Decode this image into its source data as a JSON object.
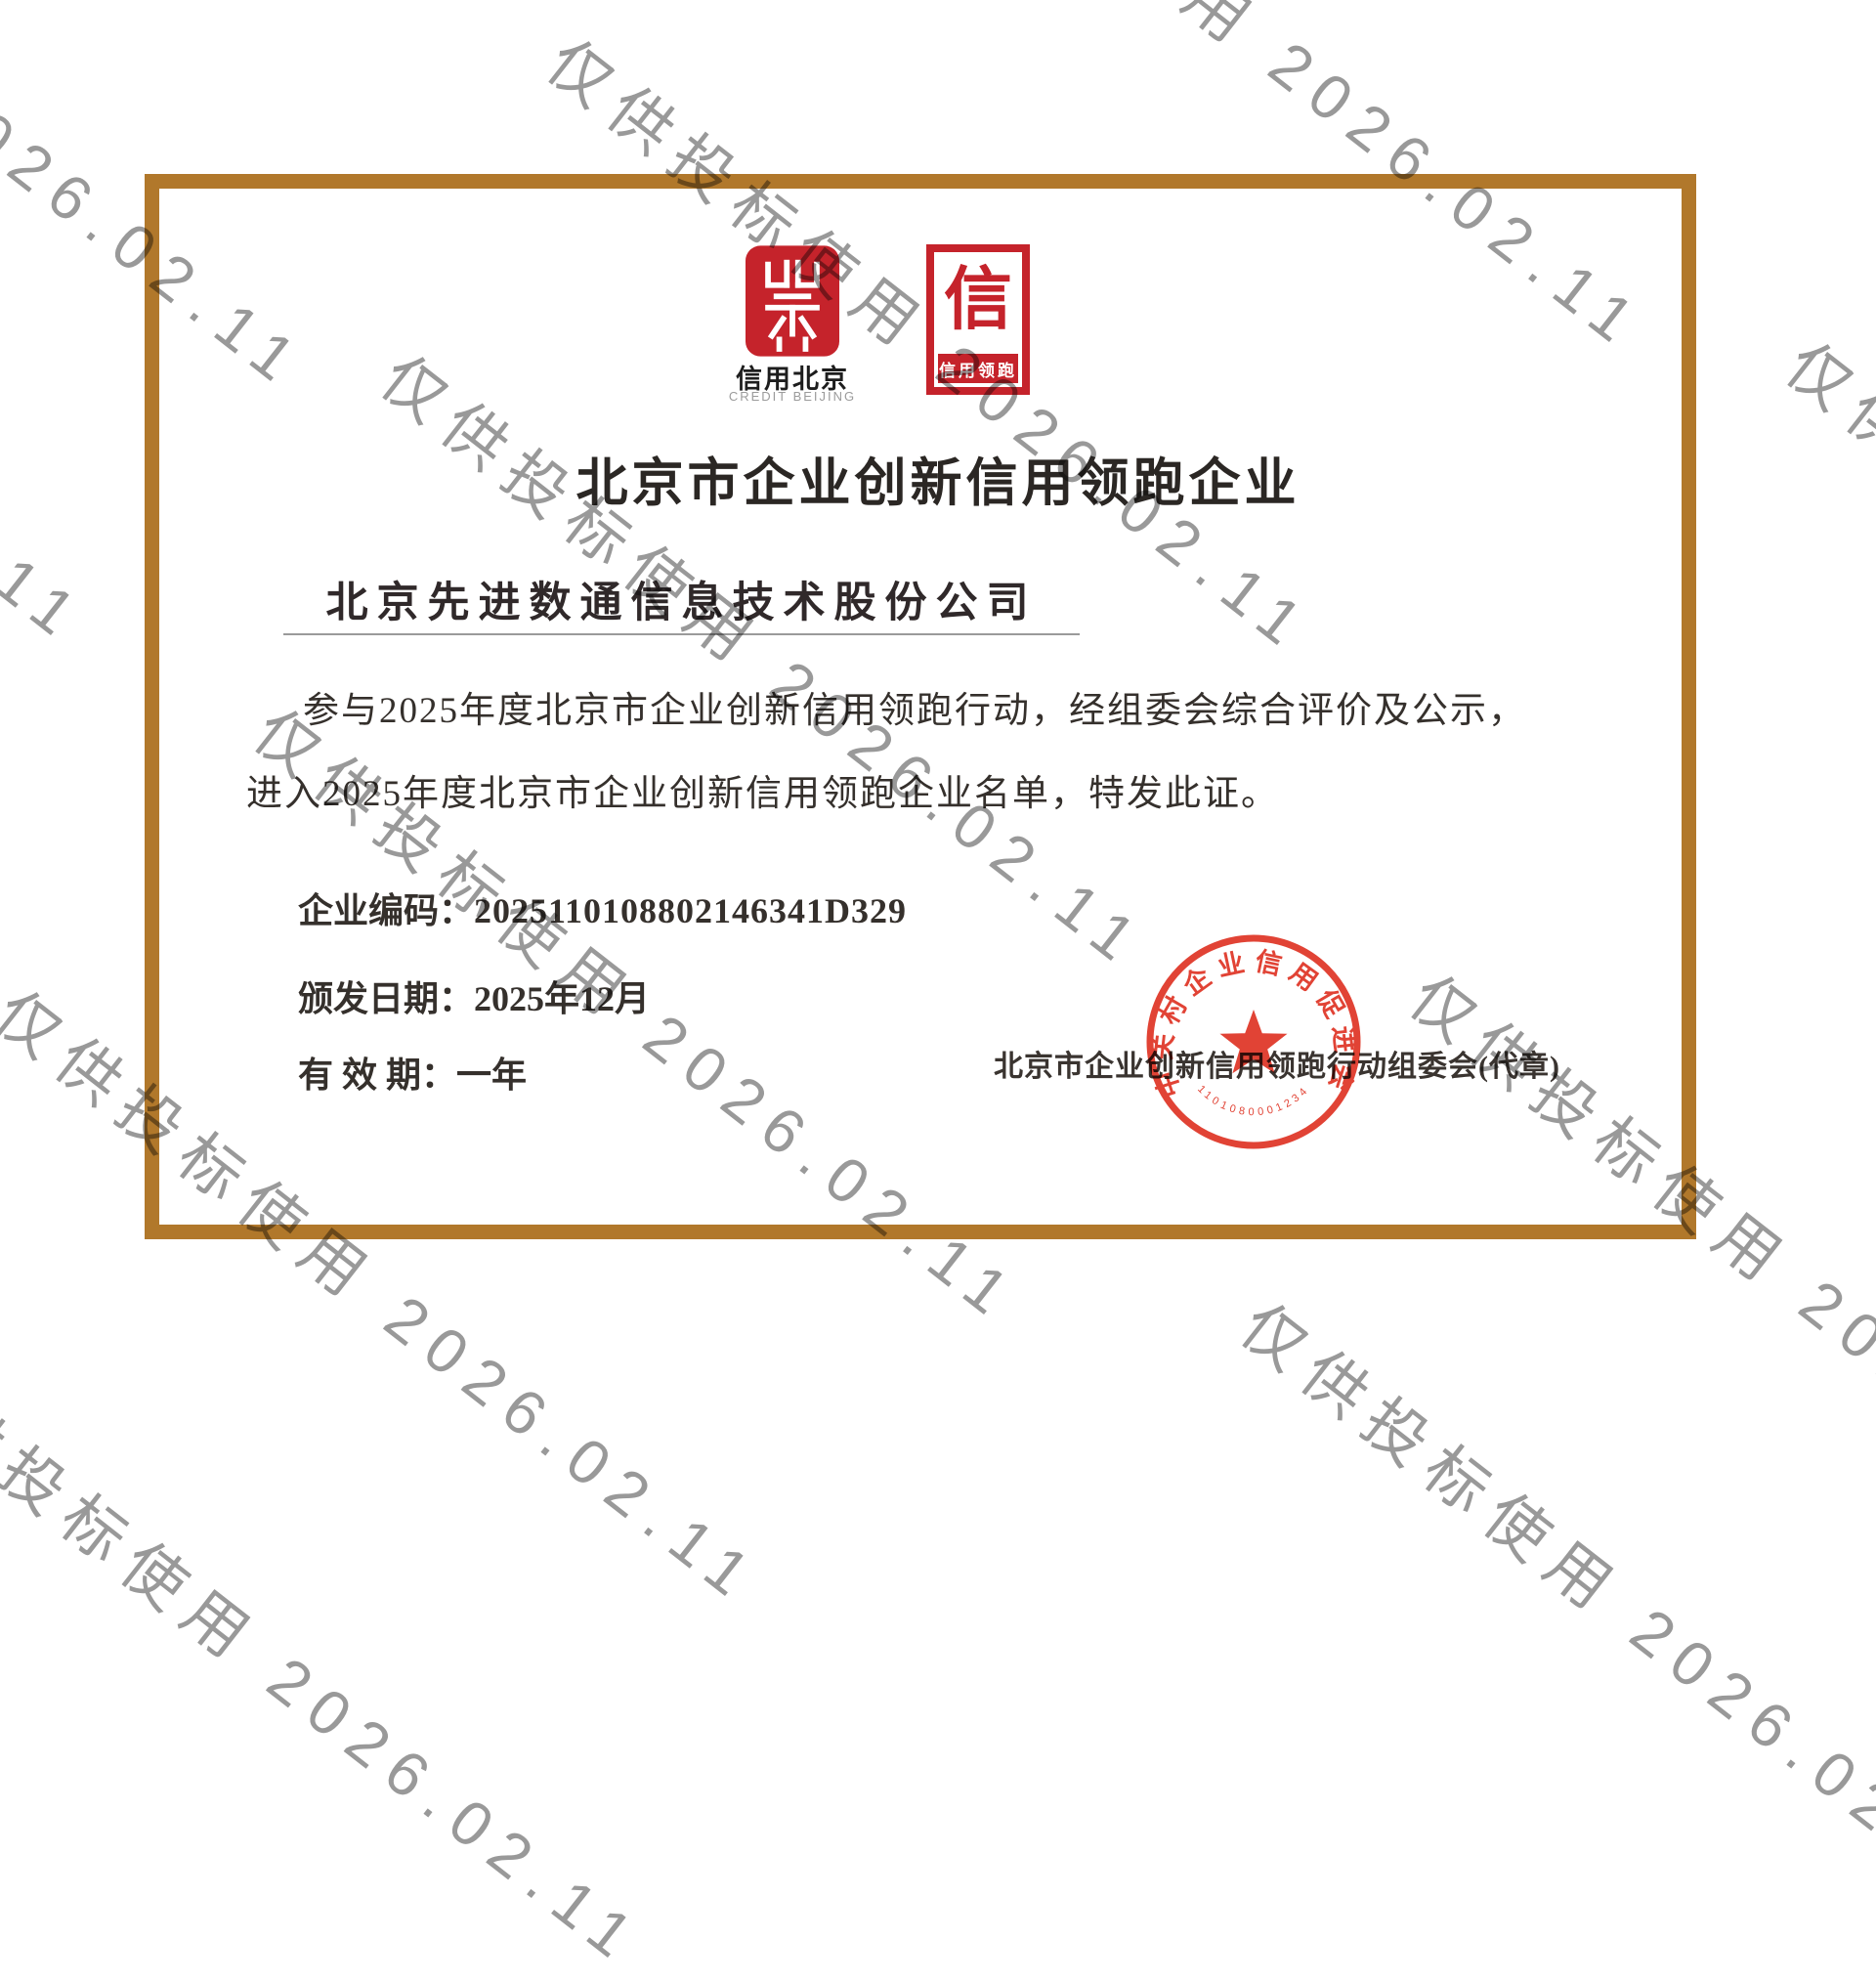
{
  "certificate": {
    "title": "北京市企业创新信用领跑企业",
    "company_name": "北京先进数通信息技术股份公司",
    "body_line1": "参与2025年度北京市企业创新信用领跑行动，经组委会综合评价及公示，",
    "body_line2": "进入2025年度北京市企业创新信用领跑企业名单，特发此证。",
    "enterprise_code_label": "企业编码：",
    "enterprise_code": "2025110108802146341D329",
    "issue_date_label": "颁发日期：",
    "issue_date": "2025年12月",
    "validity_label": "有 效 期：",
    "validity": "一年",
    "issuer": "北京市企业创新信用领跑行动组委会(代章)"
  },
  "logos": {
    "credit_beijing": {
      "caption_cn": "信用北京",
      "caption_en": "CREDIT BEIJING"
    },
    "credit_leader": {
      "glyph": "信",
      "band": "信用领跑"
    }
  },
  "seal": {
    "ring_text": "中关村企业信用促进会",
    "bottom_code": "1101080001234"
  },
  "watermark": {
    "text": "仅供投标使用 2026.02.11",
    "color": "#8e8e8e"
  },
  "colors": {
    "frame_gold": "#b1782b",
    "logo_red": "#c5232b",
    "seal_red": "#e0392a",
    "text_dark": "#35302c"
  }
}
